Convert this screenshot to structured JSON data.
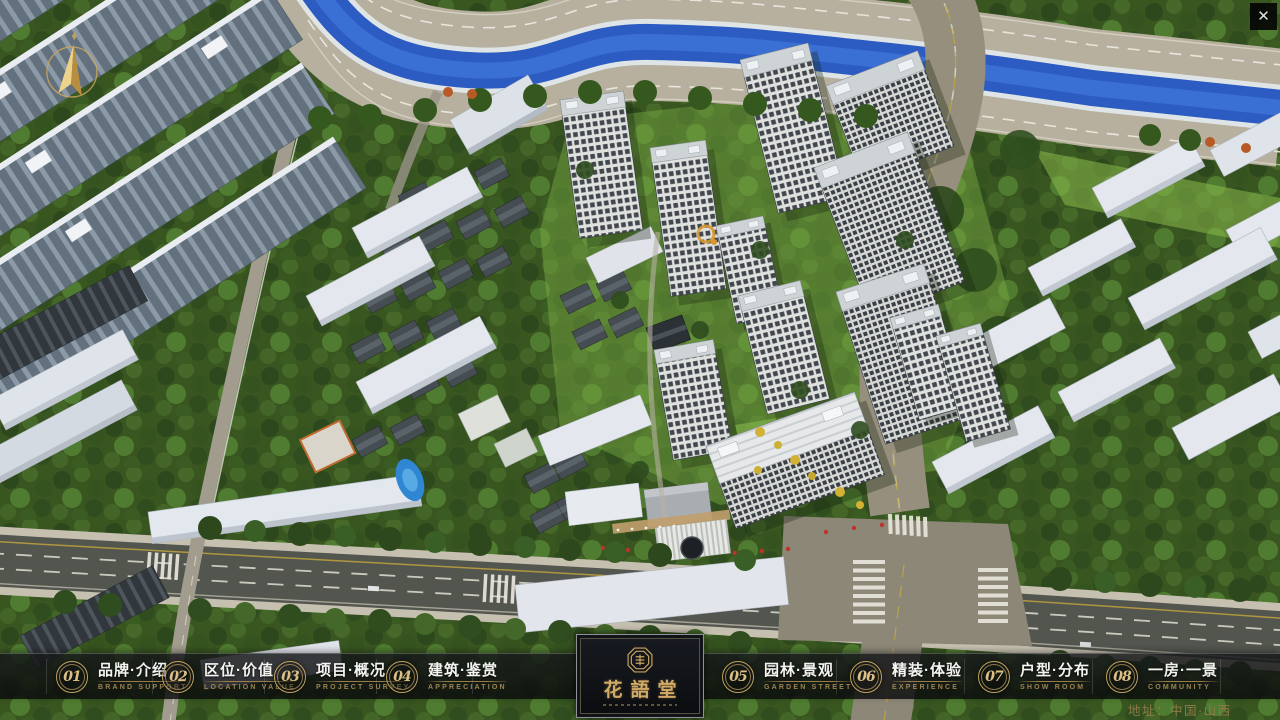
{
  "window": {
    "close_glyph": "✕"
  },
  "menu": {
    "items": [
      {
        "num": "01",
        "title": "品牌·介绍",
        "subtitle": "BRAND SUPPORT"
      },
      {
        "num": "02",
        "title": "区位·价值",
        "subtitle": "LOCATION VALUE"
      },
      {
        "num": "03",
        "title": "项目·概况",
        "subtitle": "PROJECT SURVEY"
      },
      {
        "num": "04",
        "title": "建筑·鉴赏",
        "subtitle": "APPRECIATION"
      },
      {
        "num": "05",
        "title": "园林·景观",
        "subtitle": "GARDEN STREET"
      },
      {
        "num": "06",
        "title": "精装·体验",
        "subtitle": "EXPERIENCE"
      },
      {
        "num": "07",
        "title": "户型·分布",
        "subtitle": "SHOW ROOM"
      },
      {
        "num": "08",
        "title": "一房·一景",
        "subtitle": "COMMUNITY"
      }
    ]
  },
  "logo": {
    "title": "花語堂"
  },
  "footer": {
    "address": "地址：中国·山西"
  },
  "colors": {
    "accent_gold": "#c9a45c",
    "caption_gold": "#9c8350",
    "bar_bg": "rgba(12,14,16,0.78)",
    "river_blue": "#2c5cc2",
    "lawn_green": "#7cae45",
    "asphalt": "#53554f"
  }
}
